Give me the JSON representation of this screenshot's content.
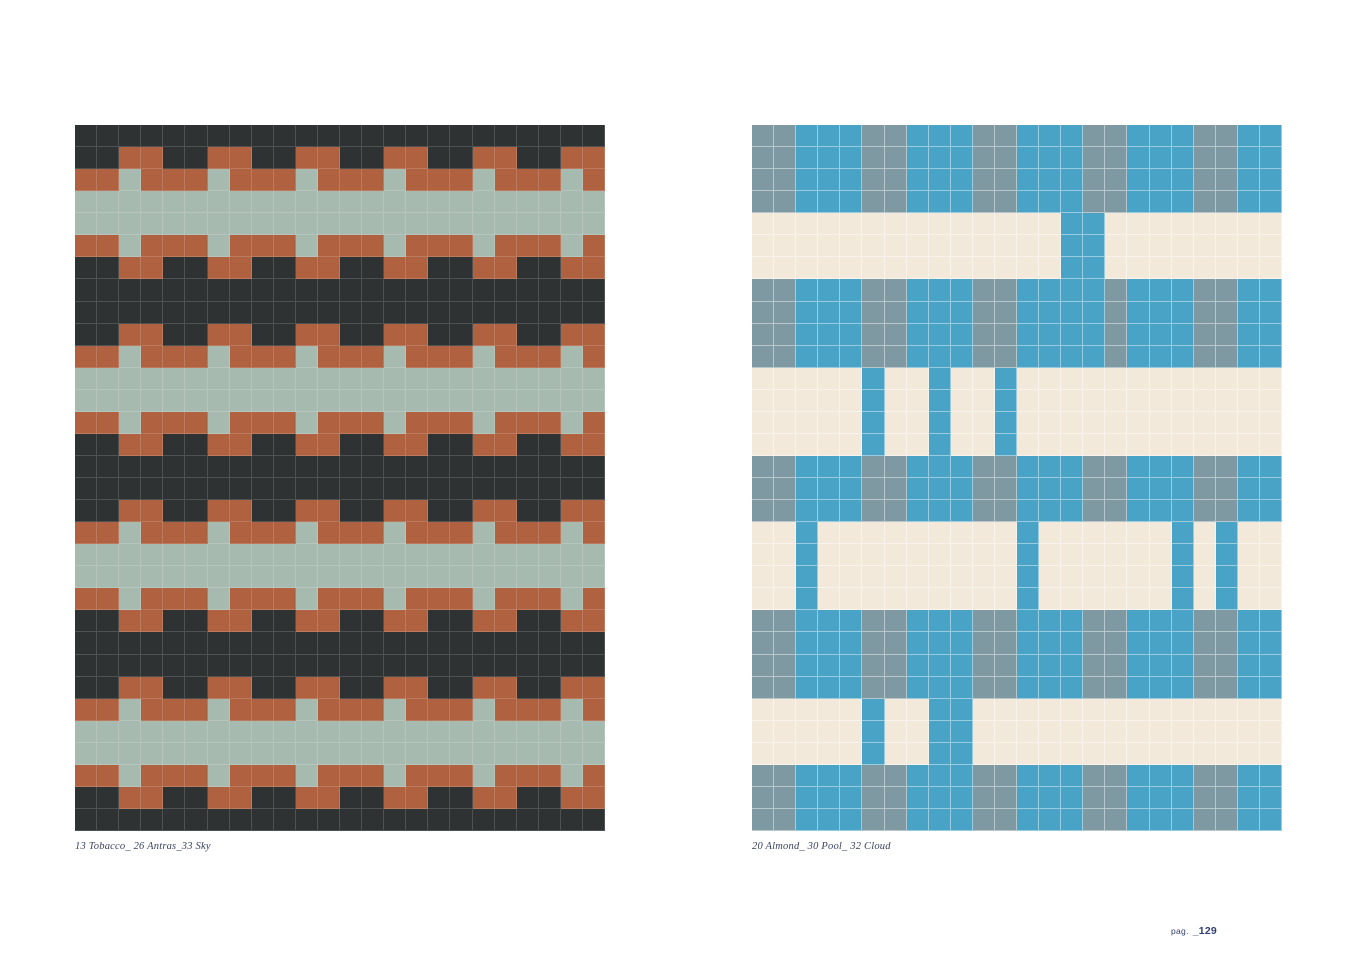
{
  "page": {
    "background": "#ffffff",
    "page_label_prefix": "pag.",
    "page_number": "_129"
  },
  "left_panel": {
    "caption": "13 Tobacco_ 26 Antras_33 Sky",
    "columns": 24,
    "rows": 32,
    "colors": {
      "D": "#2e3233",
      "R": "#b06140",
      "S": "#a7bab0"
    },
    "color_names": {
      "D": "Antras",
      "R": "Tobacco",
      "S": "Sky"
    },
    "grout": "rgba(255,255,255,0.16)",
    "pattern": [
      "DDDDDDDDDDDDDDDDDDDDDDDD",
      "DDRRDDRRDDRRDDRRDDRRDDRR",
      "RRSRRRSRRRSRRRSRRRSRRRSR",
      "SSSSSSSSSSSSSSSSSSSSSSSS",
      "SSSSSSSSSSSSSSSSSSSSSSSS",
      "RRSRRRSRRRSRRRSRRRSRRRSR",
      "DDRRDDRRDDRRDDRRDDRRDDRR",
      "DDDDDDDDDDDDDDDDDDDDDDDD",
      "DDDDDDDDDDDDDDDDDDDDDDDD",
      "DDRRDDRRDDRRDDRRDDRRDDRR",
      "RRSRRRSRRRSRRRSRRRSRRRSR",
      "SSSSSSSSSSSSSSSSSSSSSSSS",
      "SSSSSSSSSSSSSSSSSSSSSSSS",
      "RRSRRRSRRRSRRRSRRRSRRRSR",
      "DDRRDDRRDDRRDDRRDDRRDDRR",
      "DDDDDDDDDDDDDDDDDDDDDDDD",
      "DDDDDDDDDDDDDDDDDDDDDDDD",
      "DDRRDDRRDDRRDDRRDDRRDDRR",
      "RRSRRRSRRRSRRRSRRRSRRRSR",
      "SSSSSSSSSSSSSSSSSSSSSSSS",
      "SSSSSSSSSSSSSSSSSSSSSSSS",
      "RRSRRRSRRRSRRRSRRRSRRRSR",
      "DDRRDDRRDDRRDDRRDDRRDDRR",
      "DDDDDDDDDDDDDDDDDDDDDDDD",
      "DDDDDDDDDDDDDDDDDDDDDDDD",
      "DDRRDDRRDDRRDDRRDDRRDDRR",
      "RRSRRRSRRRSRRRSRRRSRRRSR",
      "SSSSSSSSSSSSSSSSSSSSSSSS",
      "SSSSSSSSSSSSSSSSSSSSSSSS",
      "RRSRRRSRRRSRRRSRRRSRRRSR",
      "DDRRDDRRDDRRDDRRDDRRDDRR",
      "DDDDDDDDDDDDDDDDDDDDDDDD"
    ]
  },
  "right_panel": {
    "caption": "20 Almond_ 30 Pool_ 32 Cloud",
    "columns": 24,
    "rows": 32,
    "colors": {
      "B": "#48a3c7",
      "G": "#7f99a2",
      "C": "#f2e9da"
    },
    "color_names": {
      "B": "Pool",
      "G": "Cloud",
      "C": "Almond"
    },
    "grout": "rgba(255,255,255,0.45)",
    "pattern": [
      "GGBBBGGBBBGGBBBGGBBBGGBB",
      "GGBBBGGBBBGGBBBGGBBBGGBB",
      "GGBBBGGBBBGGBBBGGBBBGGBB",
      "GGBBBGGBBBGGBBBGGBBBGGBB",
      "CCCCCCCCCCCCCCBBCCCCCCCC",
      "CCCCCCCCCCCCCCBBCCCCCCCC",
      "CCCCCCCCCCCCCCBBCCCCCCCC",
      "GGBBBGGBBBGGBBBBGBBBGGBB",
      "GGBBBGGBBBGGBBBBGBBBGGBB",
      "GGBBBGGBBBGGBBBBGBBBGGBB",
      "GGBBBGGBBBGGBBBBGBBBGGBB",
      "CCCCCBCCBCCBCCCCCCCCCCCC",
      "CCCCCBCCBCCBCCCCCCCCCCCC",
      "CCCCCBCCBCCBCCCCCCCCCCCC",
      "CCCCCBCCBCCBCCCCCCCCCCCC",
      "GGBBBGGBBBGGBBBGGBBBGGBB",
      "GGBBBGGBBBGGBBBGGBBBGGBB",
      "GGBBBGGBBBGGBBBGGBBBGGBB",
      "CCBCCCCCCCCCBCCCCCCBCBCC",
      "CCBCCCCCCCCCBCCCCCCBCBCC",
      "CCBCCCCCCCCCBCCCCCCBCBCC",
      "CCBCCCCCCCCCBCCCCCCBCBCC",
      "GGBBBGGBBBGGBBBGGBBBGGBB",
      "GGBBBGGBBBGGBBBGGBBBGGBB",
      "GGBBBGGBBBGGBBBGGBBBGGBB",
      "GGBBBGGBBBGGBBBGGBBBGGBB",
      "CCCCCBCCBBCCCCCCCCCCCCCC",
      "CCCCCBCCBBCCCCCCCCCCCCCC",
      "CCCCCBCCBBCCCCCCCCCCCCCC",
      "GGBBBGGBBBGGBBBGGBBBGGBB",
      "GGBBBGGBBBGGBBBGGBBBGGBB",
      "GGBBBGGBBBGGBBBGGBBBGGBB"
    ]
  }
}
